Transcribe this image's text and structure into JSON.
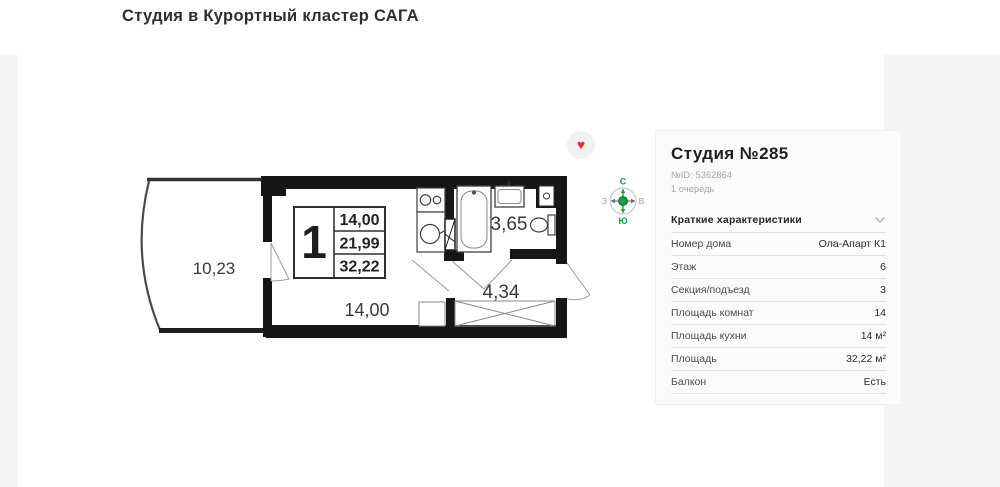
{
  "page": {
    "title": "Студия в Курортный кластер САГА"
  },
  "plan": {
    "labels": {
      "balcony_area": "10,23",
      "room_area": "14,00",
      "bathroom_area": "3,65",
      "hallway_area": "4,34"
    },
    "info_box": {
      "rooms": "1",
      "row1": "14,00",
      "row2": "21,99",
      "row3": "32,22"
    },
    "compass": {
      "north": "С",
      "south": "Ю",
      "west": "З",
      "east": "В"
    }
  },
  "icons": {
    "favorite_heart": "♥"
  },
  "colors": {
    "wall": "#161616",
    "compass_green": "#19A03A",
    "heart_red": "#e03131",
    "panel_bg": "#fbfbfc"
  },
  "panel": {
    "title": "Студия №285",
    "id_line": "№ID: 5362864",
    "queue": "1 очередь",
    "section_header": "Краткие характеристики",
    "rows": [
      {
        "label": "Номер дома",
        "value": "Ола-Апарт К1"
      },
      {
        "label": "Этаж",
        "value": "6"
      },
      {
        "label": "Секция/подъезд",
        "value": "3"
      },
      {
        "label": "Площадь комнат",
        "value": "14"
      },
      {
        "label": "Площадь кухни",
        "value": "14 м²"
      },
      {
        "label": "Площадь",
        "value": "32,22 м²"
      },
      {
        "label": "Балкон",
        "value": "Есть"
      }
    ]
  }
}
